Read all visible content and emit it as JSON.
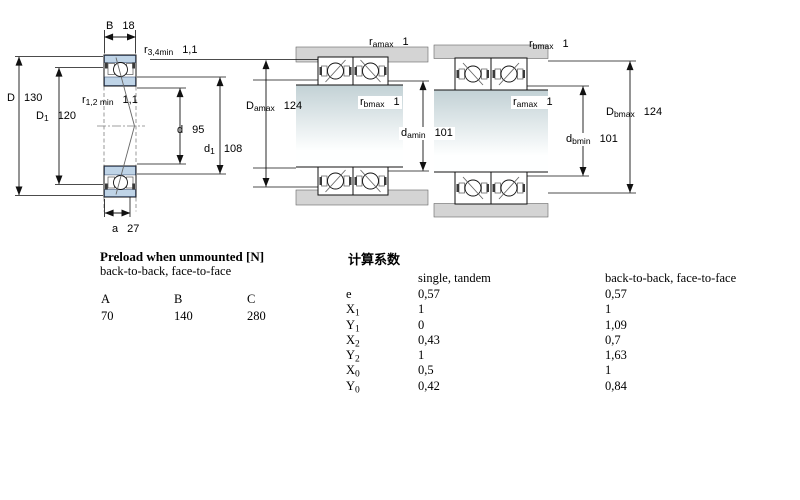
{
  "colors": {
    "bearing_ring": "#bfd4e7",
    "housing_gray": "#d4d4d4",
    "shaft_gradient_top": "#c2d1d5",
    "line": "#111111"
  },
  "section_view": {
    "labels": {
      "B": {
        "base": "B",
        "sub": "",
        "value": "18"
      },
      "r34": {
        "base": "r",
        "sub": "3,4min",
        "value": "1,1"
      },
      "D": {
        "base": "D",
        "sub": "",
        "value": "130"
      },
      "D1": {
        "base": "D",
        "sub": "1",
        "value": "120"
      },
      "r12": {
        "base": "r",
        "sub": "1,2 min",
        "value": "1,1"
      },
      "d": {
        "base": "d",
        "sub": "",
        "value": "95"
      },
      "d1": {
        "base": "d",
        "sub": "1",
        "value": "108"
      },
      "a": {
        "base": "a",
        "sub": "",
        "value": "27"
      }
    }
  },
  "back_to_back_view": {
    "labels": {
      "ramax": {
        "base": "r",
        "sub": "amax",
        "value": "1"
      },
      "rbmax": {
        "base": "r",
        "sub": "bmax",
        "value": "1"
      },
      "Damax": {
        "base": "D",
        "sub": "amax",
        "value": "124"
      },
      "damin": {
        "base": "d",
        "sub": "amin",
        "value": "101"
      }
    }
  },
  "face_to_face_view": {
    "labels": {
      "rbmax": {
        "base": "r",
        "sub": "bmax",
        "value": "1"
      },
      "ramax": {
        "base": "r",
        "sub": "amax",
        "value": "1"
      },
      "dbmin": {
        "base": "d",
        "sub": "bmin",
        "value": "101"
      },
      "Dbmax": {
        "base": "D",
        "sub": "bmax",
        "value": "124"
      }
    }
  },
  "preload": {
    "title": "Preload when unmounted [N]",
    "subtitle": "back-to-back, face-to-face",
    "headers": [
      "A",
      "B",
      "C"
    ],
    "values": [
      "70",
      "140",
      "280"
    ]
  },
  "factors": {
    "title": "计算系数",
    "col_single": "single, tandem",
    "col_b2b": "back-to-back, face-to-face",
    "rows": [
      {
        "base": "e",
        "sub": "",
        "v1": "0,57",
        "v2": "0,57"
      },
      {
        "base": "X",
        "sub": "1",
        "v1": "1",
        "v2": "1"
      },
      {
        "base": "Y",
        "sub": "1",
        "v1": "0",
        "v2": "1,09"
      },
      {
        "base": "X",
        "sub": "2",
        "v1": "0,43",
        "v2": "0,7"
      },
      {
        "base": "Y",
        "sub": "2",
        "v1": "1",
        "v2": "1,63"
      },
      {
        "base": "X",
        "sub": "0",
        "v1": "0,5",
        "v2": "1"
      },
      {
        "base": "Y",
        "sub": "0",
        "v1": "0,42",
        "v2": "0,84"
      }
    ]
  }
}
